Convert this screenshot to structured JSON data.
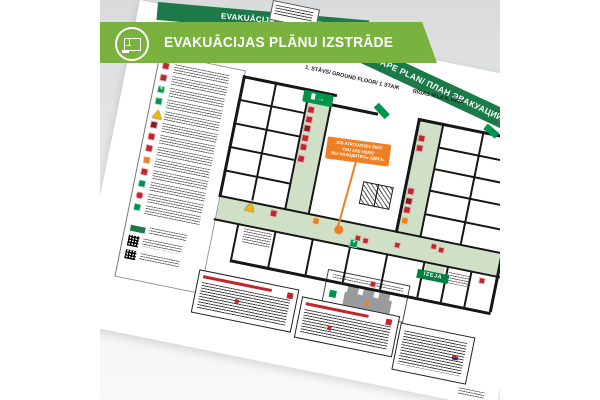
{
  "banner": {
    "title": "EVAKUĀCIJAS PLĀNU IZSTRĀDE",
    "background": "#79b23e",
    "icon": "floor-plan-circle-icon"
  },
  "document": {
    "title_band": {
      "text": "EVAKUĀCIJAS PLĀNS/ ESCAPE PLAN/ ПЛАН ЭВАКУАЦИИ",
      "background": "#1c7a49"
    },
    "subtitle": {
      "floor": "1. STĀVS/ GROUND FLOOR/ 1 ЭТАЖ",
      "address": "RĪGAS IELA 6, RĪGA"
    },
    "you_are_here_callout": {
      "lines": [
        "JŪS ATRODATIES ŠEIT/",
        "YOU ARE HERE/",
        "ВЫ НАХОДИТЕСЬ ЗДЕСЬ"
      ],
      "color": "#ef7f22"
    },
    "exit_sign_label": "IZEJA",
    "exit_chip_arrow": "→",
    "legend": {
      "rows": [
        {
          "icon": "fire-extinguisher",
          "color": "#c1272d",
          "shape": "square"
        },
        {
          "icon": "fire-hose-reel",
          "color": "#c1272d",
          "shape": "square"
        },
        {
          "icon": "first-aid-kit",
          "color": "#00934a",
          "shape": "cross"
        },
        {
          "icon": "emergency-exit",
          "color": "#00934a",
          "shape": "square"
        },
        {
          "icon": "hazard-warning",
          "color": "#f2b705",
          "shape": "triangle"
        },
        {
          "icon": "fire-hydrant",
          "color": "#8e1b1e",
          "shape": "square"
        },
        {
          "icon": "fire-equipment",
          "color": "#c1272d",
          "shape": "square"
        },
        {
          "icon": "fire-alarm-panel",
          "color": "#c1272d",
          "shape": "square"
        },
        {
          "icon": "electrical-switchboard",
          "color": "#e8821e",
          "shape": "square"
        },
        {
          "icon": "fire-alarm-call-point",
          "color": "#c1272d",
          "shape": "square"
        },
        {
          "icon": "evacuation-route",
          "color": "#00934a",
          "shape": "square"
        },
        {
          "icon": "manual-alarm-button",
          "color": "#c1272d",
          "shape": "round"
        },
        {
          "icon": "assembly-point",
          "color": "#00934a",
          "shape": "square"
        }
      ]
    },
    "colors": {
      "evacuation_route": "#cfe0c6",
      "walls": "#161616",
      "safe_green": "#00934a",
      "alarm_red": "#c1272d",
      "warning_yellow": "#f2b705",
      "orange_marker": "#ef7f22",
      "paper": "#ffffff"
    }
  }
}
